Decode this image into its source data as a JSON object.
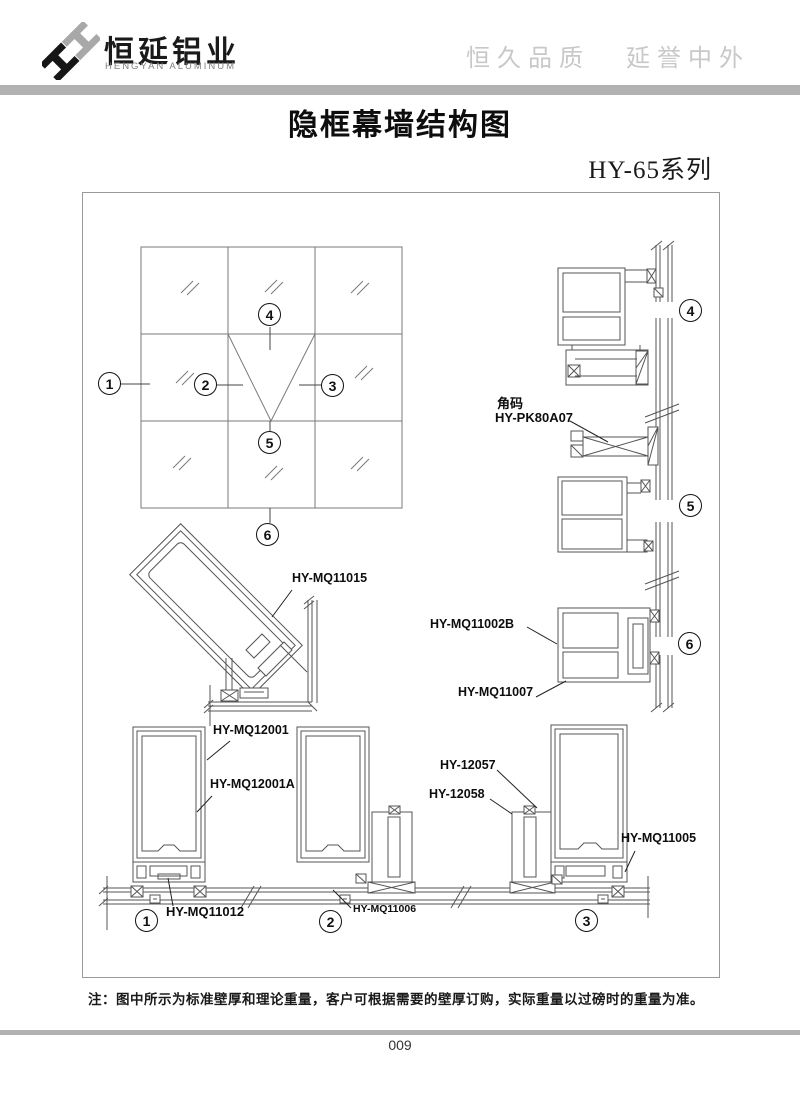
{
  "header": {
    "company_cn": "恒延铝业",
    "company_en": "HENGYAN ALUMINUM",
    "slogan_left": "恒久品质",
    "slogan_right": "延誉中外",
    "logo_icon": "double-h-diamond"
  },
  "title": "隐框幕墙结构图",
  "series": "HY-65系列",
  "note": "注：图中所示为标准壁厚和理论重量，客户可根据需要的壁厚订购，实际重量以过磅时的重量为准。",
  "page_number": "009",
  "drawing": {
    "labels": {
      "corner_code_title": "角码",
      "corner_code_model": "HY-PK80A07",
      "mq11015": "HY-MQ11015",
      "mq11002b": "HY-MQ11002B",
      "mq11007": "HY-MQ11007",
      "mq12001": "HY-MQ12001",
      "mq12001a": "HY-MQ12001A",
      "hy12057": "HY-12057",
      "hy12058": "HY-12058",
      "mq11012": "HY-MQ11012",
      "mq11006": "HY-MQ11006",
      "mq11005": "HY-MQ11005"
    },
    "callouts": {
      "g1": "1",
      "g2": "2",
      "g3": "3",
      "g4": "4",
      "g5": "5",
      "g6": "6",
      "r4": "4",
      "r5": "5",
      "r6": "6",
      "b1": "1",
      "b2": "2",
      "b3": "3"
    }
  }
}
